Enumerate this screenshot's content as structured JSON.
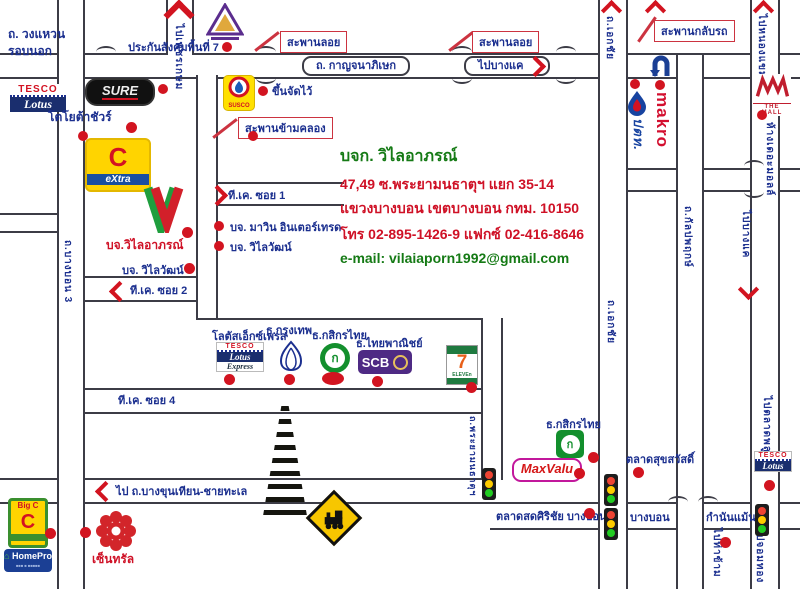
{
  "company": {
    "name": "บจก. วิไลอาภรณ์",
    "addr1": "47,49 ซ.พระยามนธาตุฯ แยก 35-14",
    "addr2": "แขวงบางบอน เขตบางบอน กทม. 10150",
    "phone": "โทร 02-895-1426-9 แฟกซ์ 02-416-8646",
    "email": "e-mail: vilaiaporn1992@gmail.com"
  },
  "roads": {
    "ring1": "ถ. วงแหวน",
    "ring2": "รอบนอก",
    "kanchanapisek": "ถ. กาญจนาภิเษก",
    "to_bangkhae": "ไปบางแค",
    "to_phetkasem": "ไปเพชรเกษม",
    "ekachai_top": "ถ.เอกชัย",
    "ekachai_mid": "ถ.เอกชัย",
    "to_nongkhaem": "ไปหนองแขม",
    "to_bangkhae_v": "ไปบางแค",
    "kanlapaphruek": "ถ.กัลปพฤกษ์",
    "to_talatphlu": "ไปตลาดพลู",
    "phrayamonthat": "ถ.พระยามนธาตุฯ",
    "to_bangkhunthian": "ไป ถ.บางขุนเทียน-ชายทะเล",
    "bangbon": "บางบอน",
    "kamnanmaen": "กำนันแม้น",
    "to_thakham": "ไปท่าข้าม",
    "to_chomthong": "ไปจอมทอง",
    "bangbon3": "ถ.บางบอน 3",
    "tk_soi1": "ที.เค. ซอย 1",
    "tk_soi2": "ที.เค. ซอย 2",
    "tk_soi4": "ที.เค. ซอย 4"
  },
  "bridges": {
    "overpass": "สะพานลอย",
    "uturn": "สะพานกลับรถ",
    "canal": "สะพานข้ามคลอง"
  },
  "places": {
    "sso": "ประกันสังคมพื้นที่ 7",
    "toyota_sure": "โตโยต้าชัวร์",
    "susco_note": "ขึ้นจัดไว้",
    "marin": "บจ. มาวิน อินเตอร์เทรด",
    "wilaiwat": "บจ. วิไลวัฒน์",
    "wilaiaporn": "บจ.วิไลอาภรณ์",
    "lotus_express": "โลตัสเอ็กซ์เพรส",
    "bbl": "ธ.กรุงเทพ",
    "kbank": "ธ.กสิกรไทย",
    "scb": "ธ.ไทยพาณิชย์",
    "suksawat": "ตลาดสุขสวัสดิ์",
    "sirichai": "ตลาดสดศิริชัย บางบอน",
    "the_mall": "ห้างเดอะมอลล์",
    "central": "เซ็นทรัล"
  },
  "logos": {
    "tesco": "TESCO",
    "lotus": "Lotus",
    "express": "Express",
    "sure": "SURE",
    "bigc_c": "C",
    "extra": "eXtra",
    "bigc_small": "Big C",
    "susco": "SUSCO",
    "makro": "makro",
    "ptt": "ปตท.",
    "mall_text": "THE MALL",
    "seven": "7",
    "eleven": "ELEVEn",
    "scb": "SCB",
    "kbank_k": "ก",
    "maxvalu": "MaxValu",
    "homepro": "HomePro"
  },
  "palette": {
    "road_line": "#3c3c46",
    "marker_red": "#d21420",
    "label_blue": "#1b2f8f",
    "text_red": "#cf1126",
    "text_green": "#157a15"
  }
}
